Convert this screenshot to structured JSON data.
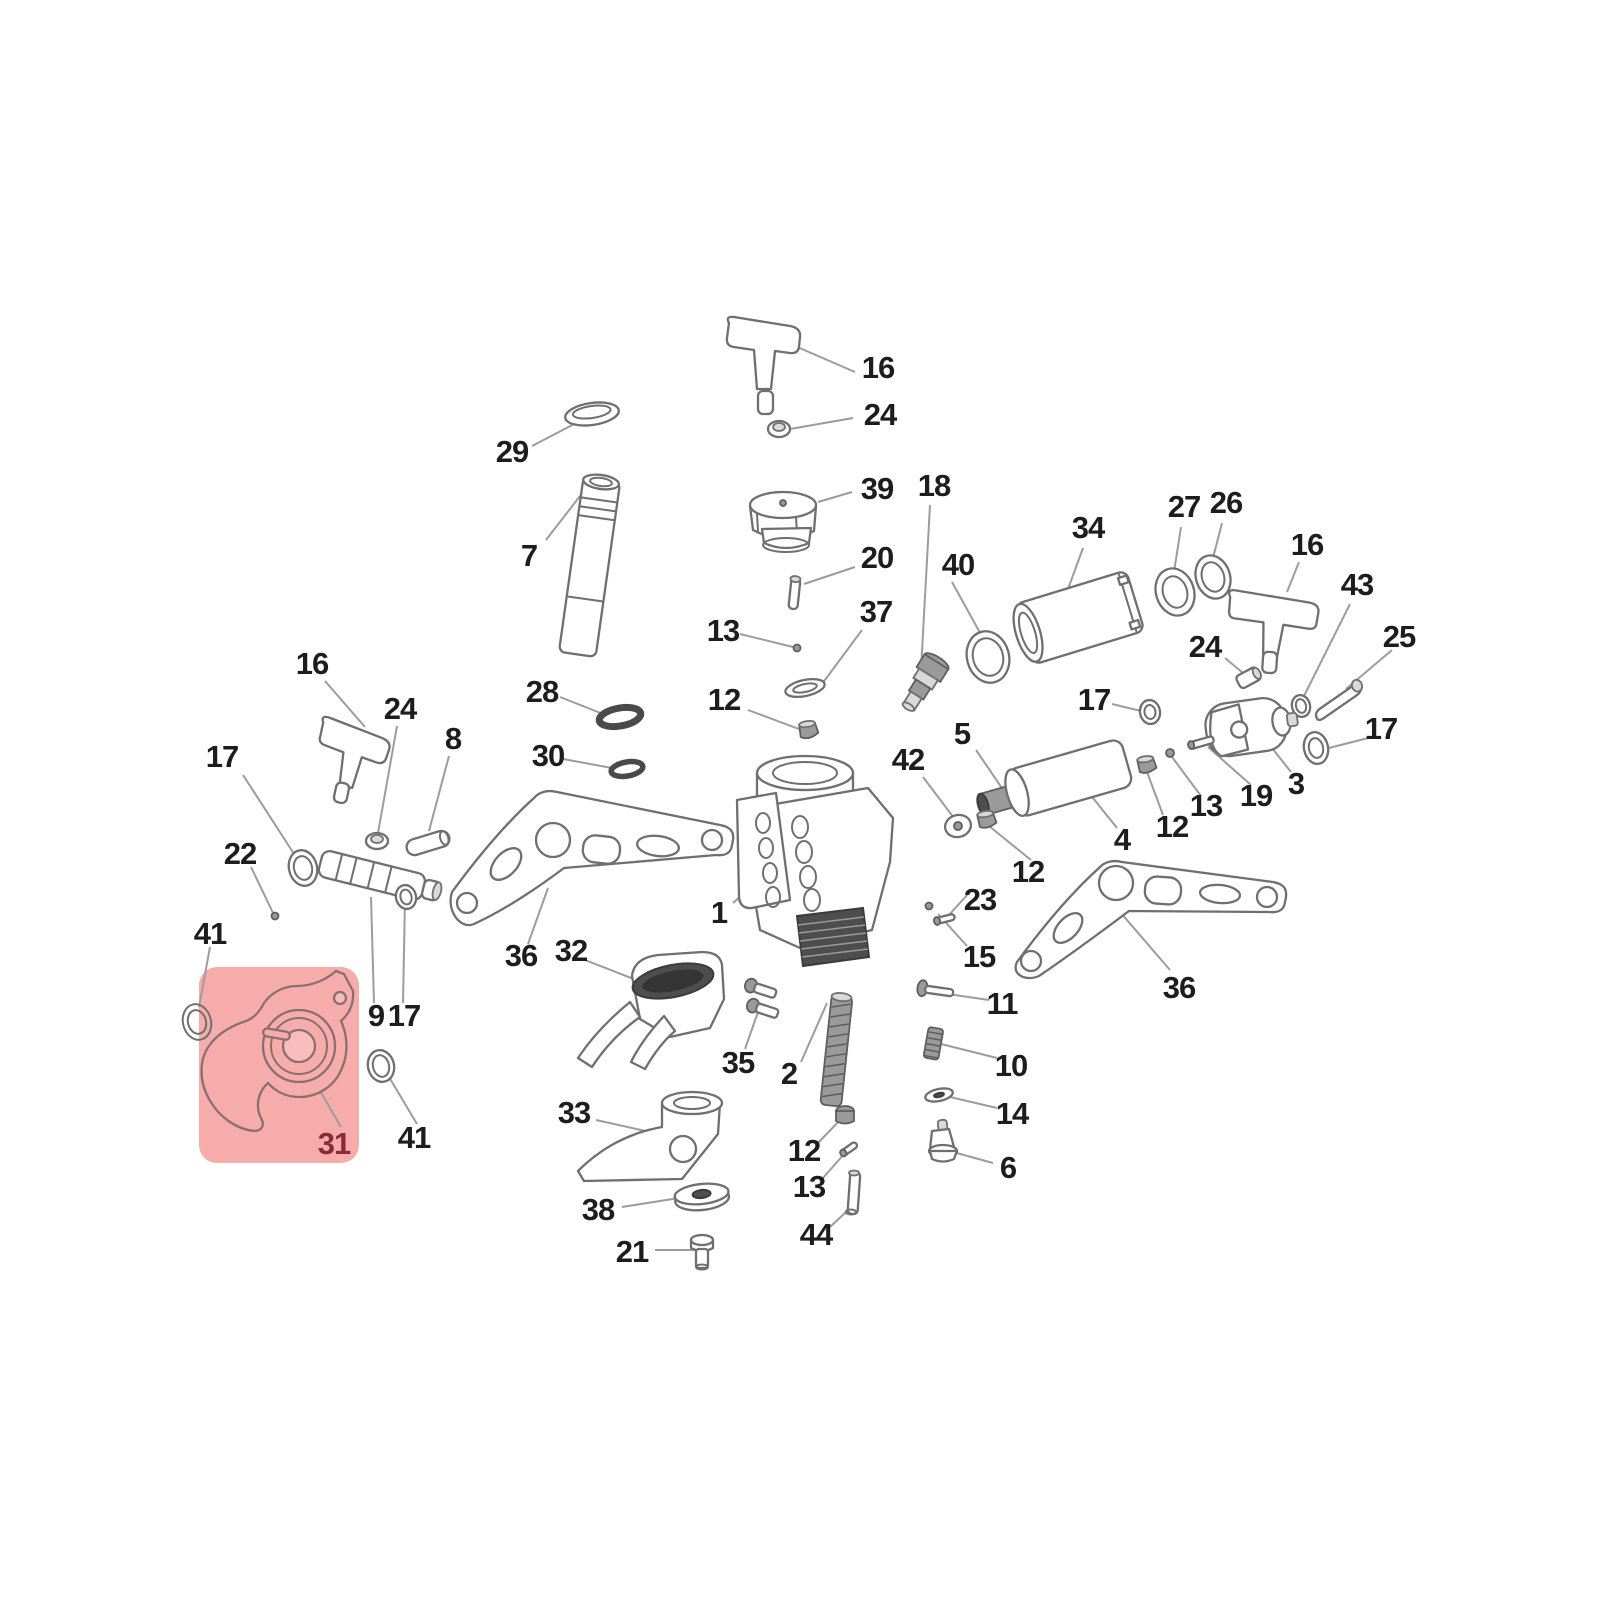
{
  "diagram": {
    "type": "exploded-parts-diagram",
    "background": "#ffffff",
    "leader_color": "#9c9c9c",
    "label_color": "#1d1d1d"
  },
  "highlight": {
    "x": 199,
    "y": 967,
    "width": 160,
    "height": 196,
    "radius": 18,
    "fill": "#f7acac",
    "highlighted_part": "31",
    "label_color": "#8b2a33"
  },
  "labels": [
    {
      "id": "16-top",
      "t": "16",
      "x": 878,
      "y": 368
    },
    {
      "id": "24-top",
      "t": "24",
      "x": 880,
      "y": 415
    },
    {
      "id": "29",
      "t": "29",
      "x": 512,
      "y": 452
    },
    {
      "id": "39",
      "t": "39",
      "x": 877,
      "y": 489
    },
    {
      "id": "18",
      "t": "18",
      "x": 934,
      "y": 486
    },
    {
      "id": "7",
      "t": "7",
      "x": 529,
      "y": 556
    },
    {
      "id": "20",
      "t": "20",
      "x": 877,
      "y": 558
    },
    {
      "id": "40",
      "t": "40",
      "x": 958,
      "y": 565
    },
    {
      "id": "34",
      "t": "34",
      "x": 1088,
      "y": 528
    },
    {
      "id": "27",
      "t": "27",
      "x": 1184,
      "y": 507
    },
    {
      "id": "26",
      "t": "26",
      "x": 1226,
      "y": 503
    },
    {
      "id": "16-right",
      "t": "16",
      "x": 1307,
      "y": 545
    },
    {
      "id": "43",
      "t": "43",
      "x": 1357,
      "y": 585
    },
    {
      "id": "25",
      "t": "25",
      "x": 1399,
      "y": 637
    },
    {
      "id": "13-center",
      "t": "13",
      "x": 723,
      "y": 631
    },
    {
      "id": "37",
      "t": "37",
      "x": 876,
      "y": 612
    },
    {
      "id": "28",
      "t": "28",
      "x": 542,
      "y": 692
    },
    {
      "id": "12-center",
      "t": "12",
      "x": 724,
      "y": 700
    },
    {
      "id": "24-right",
      "t": "24",
      "x": 1205,
      "y": 647
    },
    {
      "id": "17-mid",
      "t": "17",
      "x": 1094,
      "y": 700
    },
    {
      "id": "16-left",
      "t": "16",
      "x": 312,
      "y": 664
    },
    {
      "id": "24-left",
      "t": "24",
      "x": 400,
      "y": 709
    },
    {
      "id": "8",
      "t": "8",
      "x": 453,
      "y": 739
    },
    {
      "id": "30",
      "t": "30",
      "x": 548,
      "y": 756
    },
    {
      "id": "5",
      "t": "5",
      "x": 962,
      "y": 734
    },
    {
      "id": "17-far-right",
      "t": "17",
      "x": 1381,
      "y": 729
    },
    {
      "id": "42",
      "t": "42",
      "x": 908,
      "y": 760
    },
    {
      "id": "17-left",
      "t": "17",
      "x": 222,
      "y": 757
    },
    {
      "id": "3",
      "t": "3",
      "x": 1296,
      "y": 784
    },
    {
      "id": "19",
      "t": "19",
      "x": 1256,
      "y": 796
    },
    {
      "id": "13-right",
      "t": "13",
      "x": 1206,
      "y": 806
    },
    {
      "id": "12-right",
      "t": "12",
      "x": 1172,
      "y": 827
    },
    {
      "id": "22",
      "t": "22",
      "x": 240,
      "y": 854
    },
    {
      "id": "1",
      "t": "1",
      "x": 719,
      "y": 913
    },
    {
      "id": "4",
      "t": "4",
      "x": 1122,
      "y": 840
    },
    {
      "id": "12-mid",
      "t": "12",
      "x": 1028,
      "y": 872
    },
    {
      "id": "23",
      "t": "23",
      "x": 980,
      "y": 900
    },
    {
      "id": "36-left",
      "t": "36",
      "x": 521,
      "y": 956
    },
    {
      "id": "32",
      "t": "32",
      "x": 571,
      "y": 951
    },
    {
      "id": "15",
      "t": "15",
      "x": 979,
      "y": 957
    },
    {
      "id": "41-left",
      "t": "41",
      "x": 210,
      "y": 934
    },
    {
      "id": "9",
      "t": "9",
      "x": 376,
      "y": 1016
    },
    {
      "id": "17-bottom",
      "t": "17",
      "x": 404,
      "y": 1016
    },
    {
      "id": "11",
      "t": "11",
      "x": 1002,
      "y": 1004
    },
    {
      "id": "35",
      "t": "35",
      "x": 738,
      "y": 1063
    },
    {
      "id": "2",
      "t": "2",
      "x": 789,
      "y": 1074
    },
    {
      "id": "10",
      "t": "10",
      "x": 1011,
      "y": 1066
    },
    {
      "id": "36-right",
      "t": "36",
      "x": 1179,
      "y": 988
    },
    {
      "id": "31",
      "t": "31",
      "x": 334,
      "y": 1144,
      "c": "#8b2a33"
    },
    {
      "id": "41-bottom",
      "t": "41",
      "x": 414,
      "y": 1138
    },
    {
      "id": "14",
      "t": "14",
      "x": 1012,
      "y": 1114
    },
    {
      "id": "33",
      "t": "33",
      "x": 574,
      "y": 1113
    },
    {
      "id": "12-bottom",
      "t": "12",
      "x": 804,
      "y": 1151
    },
    {
      "id": "6",
      "t": "6",
      "x": 1008,
      "y": 1168
    },
    {
      "id": "13-bottom",
      "t": "13",
      "x": 809,
      "y": 1187
    },
    {
      "id": "38",
      "t": "38",
      "x": 598,
      "y": 1210
    },
    {
      "id": "44",
      "t": "44",
      "x": 816,
      "y": 1235
    },
    {
      "id": "21",
      "t": "21",
      "x": 632,
      "y": 1252
    }
  ],
  "leaders": [
    [
      855,
      372,
      795,
      346
    ],
    [
      853,
      418,
      790,
      429
    ],
    [
      532,
      446,
      578,
      422
    ],
    [
      852,
      492,
      818,
      502
    ],
    [
      930,
      505,
      921,
      670
    ],
    [
      546,
      540,
      580,
      496
    ],
    [
      855,
      567,
      804,
      584
    ],
    [
      952,
      582,
      984,
      640
    ],
    [
      1083,
      548,
      1064,
      600
    ],
    [
      1181,
      527,
      1174,
      572
    ],
    [
      1222,
      523,
      1213,
      558
    ],
    [
      1299,
      562,
      1287,
      592
    ],
    [
      1350,
      604,
      1302,
      700
    ],
    [
      1392,
      650,
      1346,
      689
    ],
    [
      740,
      634,
      793,
      647
    ],
    [
      862,
      630,
      822,
      684
    ],
    [
      560,
      697,
      603,
      714
    ],
    [
      748,
      710,
      799,
      729
    ],
    [
      1225,
      658,
      1243,
      673
    ],
    [
      1112,
      704,
      1141,
      711
    ],
    [
      325,
      681,
      365,
      727
    ],
    [
      397,
      726,
      378,
      833
    ],
    [
      449,
      756,
      429,
      831
    ],
    [
      563,
      759,
      612,
      768
    ],
    [
      976,
      750,
      1008,
      797
    ],
    [
      1372,
      737,
      1329,
      748
    ],
    [
      923,
      777,
      954,
      818
    ],
    [
      243,
      775,
      296,
      857
    ],
    [
      1291,
      772,
      1272,
      748
    ],
    [
      1251,
      785,
      1208,
      747
    ],
    [
      1201,
      796,
      1172,
      757
    ],
    [
      1163,
      815,
      1147,
      772
    ],
    [
      251,
      867,
      274,
      915
    ],
    [
      733,
      903,
      772,
      868
    ],
    [
      1117,
      828,
      1089,
      793
    ],
    [
      1031,
      860,
      989,
      826
    ],
    [
      969,
      893,
      948,
      916
    ],
    [
      528,
      944,
      548,
      888
    ],
    [
      585,
      960,
      644,
      983
    ],
    [
      967,
      946,
      938,
      914
    ],
    [
      210,
      947,
      199,
      1007
    ],
    [
      374,
      1003,
      371,
      897
    ],
    [
      403,
      1003,
      405,
      899
    ],
    [
      989,
      1000,
      941,
      993
    ],
    [
      745,
      1049,
      758,
      1012
    ],
    [
      801,
      1062,
      827,
      1003
    ],
    [
      997,
      1058,
      941,
      1044
    ],
    [
      1170,
      970,
      1108,
      898
    ],
    [
      341,
      1127,
      301,
      1058
    ],
    [
      417,
      1124,
      389,
      1077
    ],
    [
      997,
      1108,
      950,
      1097
    ],
    [
      596,
      1120,
      659,
      1134
    ],
    [
      818,
      1143,
      841,
      1119
    ],
    [
      993,
      1163,
      953,
      1152
    ],
    [
      823,
      1178,
      845,
      1153
    ],
    [
      622,
      1207,
      679,
      1198
    ],
    [
      830,
      1227,
      846,
      1212
    ],
    [
      655,
      1250,
      696,
      1250
    ]
  ]
}
